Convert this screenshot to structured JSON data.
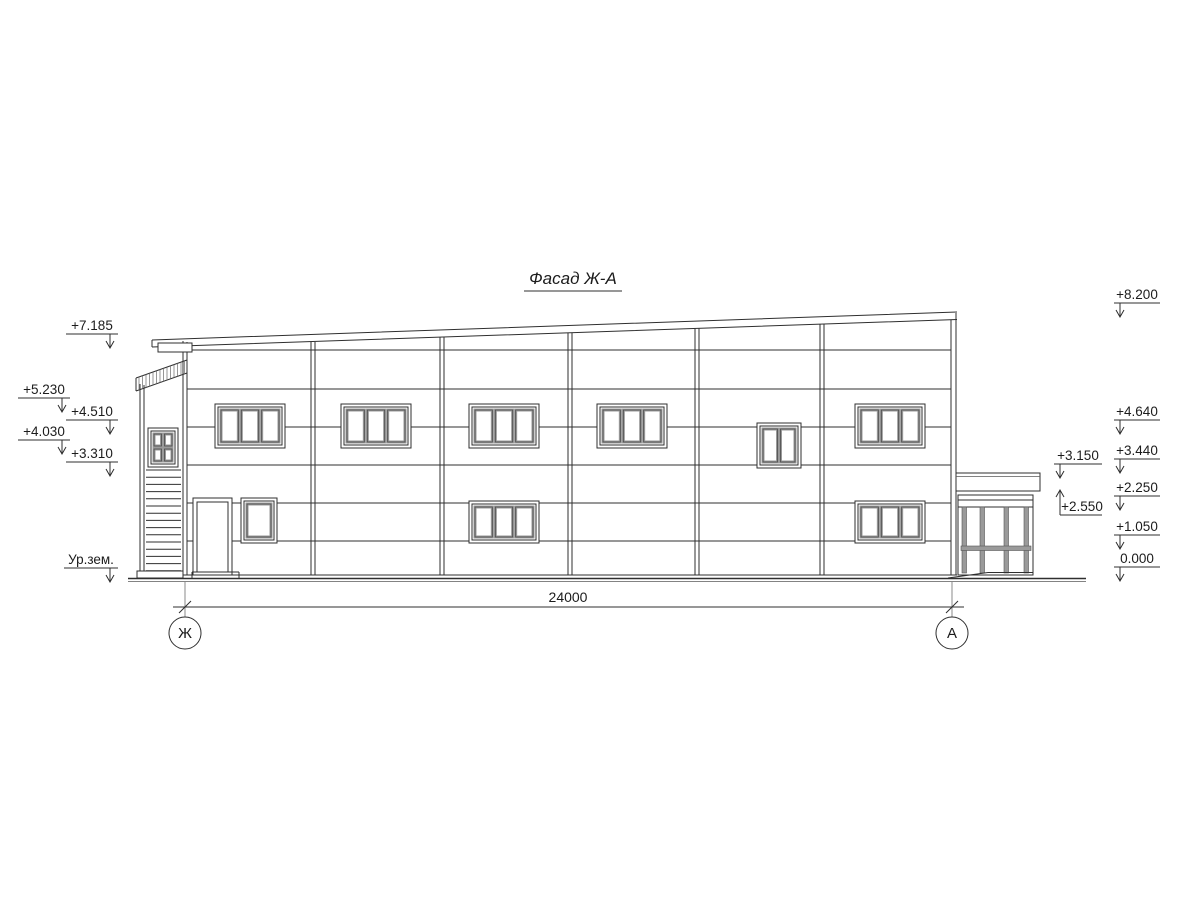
{
  "drawing": {
    "title": "Фасад Ж-А"
  },
  "dimension": {
    "total": "24000"
  },
  "axes": {
    "left": "Ж",
    "right": "А"
  },
  "elevation_marks": {
    "left": [
      "+7.185",
      "+5.230",
      "+4.510",
      "+4.030",
      "+3.310"
    ],
    "ground_label": "Ур.зем.",
    "right": [
      "+8.200",
      "+4.640",
      "+3.440",
      "+2.250",
      "+1.050",
      "0.000"
    ],
    "annex": [
      "+3.150",
      "+2.550"
    ]
  },
  "colors": {
    "background": "#ffffff",
    "line": "#2f2f2f",
    "frame_gray": "#9a9a9a"
  }
}
